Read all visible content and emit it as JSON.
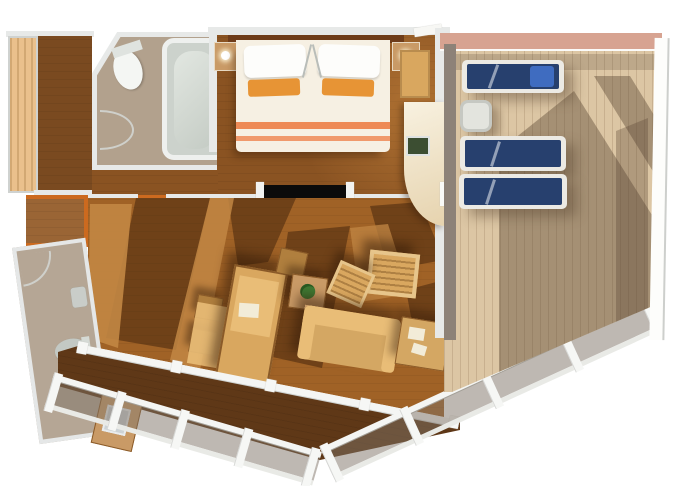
{
  "canvas": {
    "width": 680,
    "height": 486
  },
  "colors": {
    "page_bg": "#ffffff",
    "wall": "#e7e9e8",
    "wall_shade": "#c9cdcc",
    "floor_dark": "#7a471c",
    "floor_bedroom": "#8a5322",
    "floor_caramel": "#a06226",
    "floor_light_patch": "#c28744",
    "floor_shadow": "rgba(50,26,8,0.45)",
    "floor_balcony": "#5f3817",
    "hall_floor": "#7a4a20",
    "closet_floor": "#9a6535",
    "threshold": "#cc6a1f",
    "wood_light": "#eac08c",
    "bath_floor": "#b2a18d",
    "bath2_floor": "#b5a695",
    "tub_fill": "#ccd2cc",
    "tub_edge": "#eef0ee",
    "porcelain": "#f4f6f3",
    "bed_duvet": "#f6f0e3",
    "bed_sheet_white": "#fdfdfb",
    "pillow_orange": "#e79435",
    "stripe_orange": "#ee8a56",
    "headboard": "#6e3c1a",
    "nightstand": "#c99a66",
    "tan": "#d9a75f",
    "tan_light": "#e9bd77",
    "tan_dark": "#b07f3e",
    "sofa_tan": "#d4a763",
    "deck_wood": "#dcc6a4",
    "deck_shadow": "rgba(88,68,50,0.42)",
    "deck_wall": "#8d8278",
    "deck_top_wall": "#d7a391",
    "navy": "#27406e",
    "towel_blue": "#3f6cc0",
    "frame_white": "#eceae4",
    "glass": "rgba(126,113,101,0.5)",
    "rail_white": "#f4f5f3",
    "tv_black": "#0b0b0b",
    "screen_green": "#3c4e32",
    "plant": "#3f7a33",
    "table_white": "#e3e4de",
    "paper": "#f2ecd8"
  },
  "scene": {
    "type": "cruise-suite-floor-plan-3d-top-view",
    "rooms": [
      "bedroom",
      "main-bathroom",
      "second-bathroom",
      "living-dining-room",
      "entry-hall-wardrobe",
      "private-sun-deck",
      "balcony"
    ],
    "furniture": {
      "bedroom": [
        "double-bed",
        "white-pillows",
        "orange-accent-pillows",
        "nightstand-left",
        "nightstand-right",
        "closet",
        "flat-tv-on-partition"
      ],
      "main-bathroom": [
        "bathtub",
        "toilet",
        "door-swing"
      ],
      "second-bathroom": [
        "toilet",
        "sink",
        "door-swing"
      ],
      "living-dining-room": [
        "dining-table",
        "dining-chairs",
        "bench",
        "wicker-armchair-1",
        "wicker-armchair-2",
        "plant-side-table",
        "sofa",
        "sofa-side-table",
        "curved-desk",
        "desk-screen"
      ],
      "private-sun-deck": [
        "sun-lounger-1",
        "sun-lounger-2",
        "sun-lounger-3",
        "white-side-table"
      ],
      "balcony": [
        "glass-railing",
        "railing-posts",
        "small-table"
      ]
    },
    "counts": {
      "sun_loungers": 3,
      "bathrooms": 2,
      "toilets": 2,
      "beds": 1
    }
  }
}
